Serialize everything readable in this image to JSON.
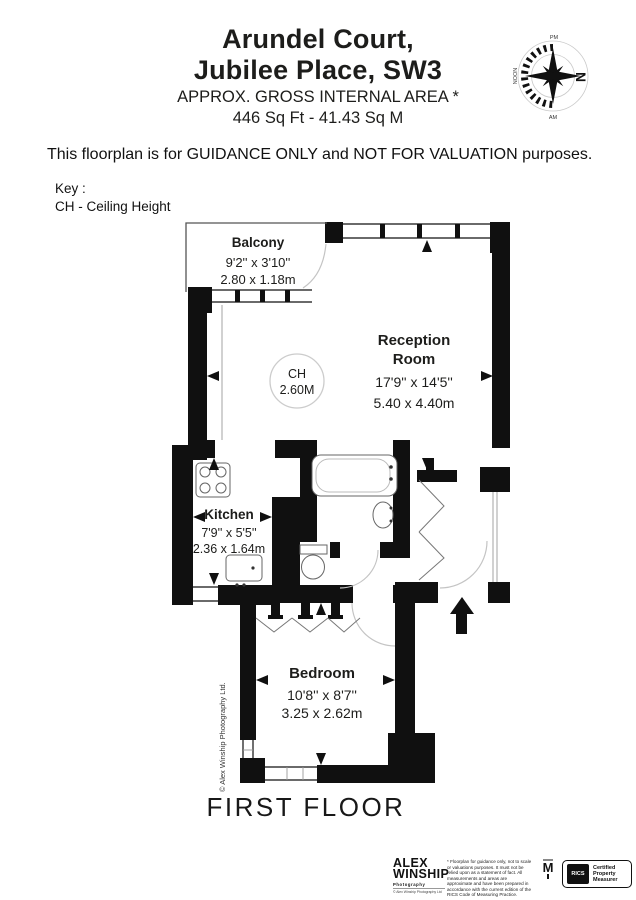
{
  "header": {
    "title_line1": "Arundel Court,",
    "title_line2": "Jubilee Place, SW3",
    "area_line1": "APPROX. GROSS INTERNAL  AREA *",
    "area_line2": "446 Sq Ft  -  41.43 Sq M",
    "disclaimer": "This floorplan is for GUIDANCE ONLY and NOT FOR VALUATION purposes.",
    "key_label": "Key :",
    "key_item": "CH - Ceiling Height"
  },
  "compass": {
    "north_label": "N",
    "pm_label": "PM",
    "noon_label": "NOON",
    "am_label": "AM"
  },
  "plan": {
    "balcony": {
      "name": "Balcony",
      "imperial": "9'2'' x 3'10''",
      "metric": "2.80 x 1.18m"
    },
    "reception": {
      "name_line1": "Reception",
      "name_line2": "Room",
      "imperial": "17'9'' x 14'5''",
      "metric": "5.40 x 4.40m"
    },
    "ceiling_height": {
      "label": "CH",
      "value": "2.60M"
    },
    "kitchen": {
      "name": "Kitchen",
      "imperial": "7'9'' x 5'5''",
      "metric": "2.36 x 1.64m"
    },
    "bedroom": {
      "name": "Bedroom",
      "imperial": "10'8'' x 8'7''",
      "metric": "3.25 x 2.62m"
    },
    "floor_label": "FIRST FLOOR",
    "copyright_vertical": "© Alex Winship Photography Ltd."
  },
  "footer": {
    "logo_line1": "ALEX",
    "logo_line2": "WINSHIP",
    "logo_line3": "Photography",
    "logo_line4": "© Alex Winship Photography Ltd",
    "small_print": "* Floorplan for guidance only, not to scale or valuations purposes. It must not be relied upon as a statement of fact. All measurements and areas are approximate and have been prepared in accordance with the current edition of the RICS Code of Measuring Practice.",
    "m_mark": "M",
    "rics_label": "RICS",
    "rics_text": "Certified Property Measurer"
  },
  "colors": {
    "wall": "#101010",
    "door_arc": "#c4c4c4",
    "fixture_line": "#666666",
    "circle_stroke": "#cccccc"
  }
}
